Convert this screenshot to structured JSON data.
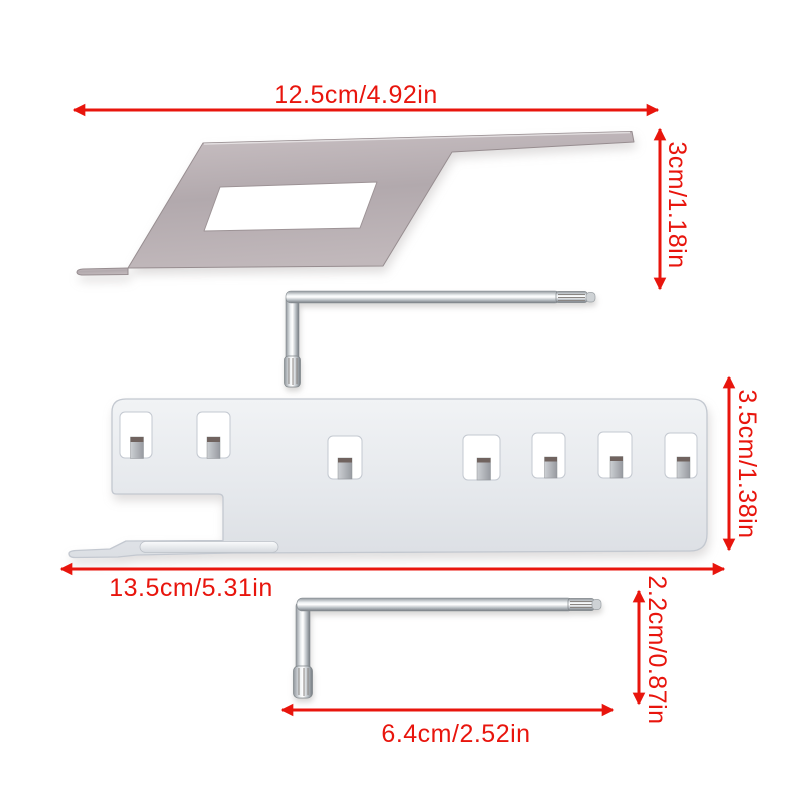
{
  "dimensions": {
    "plate_width": "12.5cm/4.92in",
    "plate_height": "3cm/1.18in",
    "bracket_height": "3.5cm/1.38in",
    "bracket_width": "13.5cm/5.31in",
    "wrench_height": "2.2cm/0.87in",
    "wrench_width": "6.4cm/2.52in"
  },
  "colors": {
    "dimension": "#e8150d",
    "background": "#ffffff",
    "plate_metal": "#b4abaf",
    "bracket_metal": "#e9ebee",
    "wrench_chrome": "#e8ebed",
    "tab_metal": "#a9acb1"
  }
}
